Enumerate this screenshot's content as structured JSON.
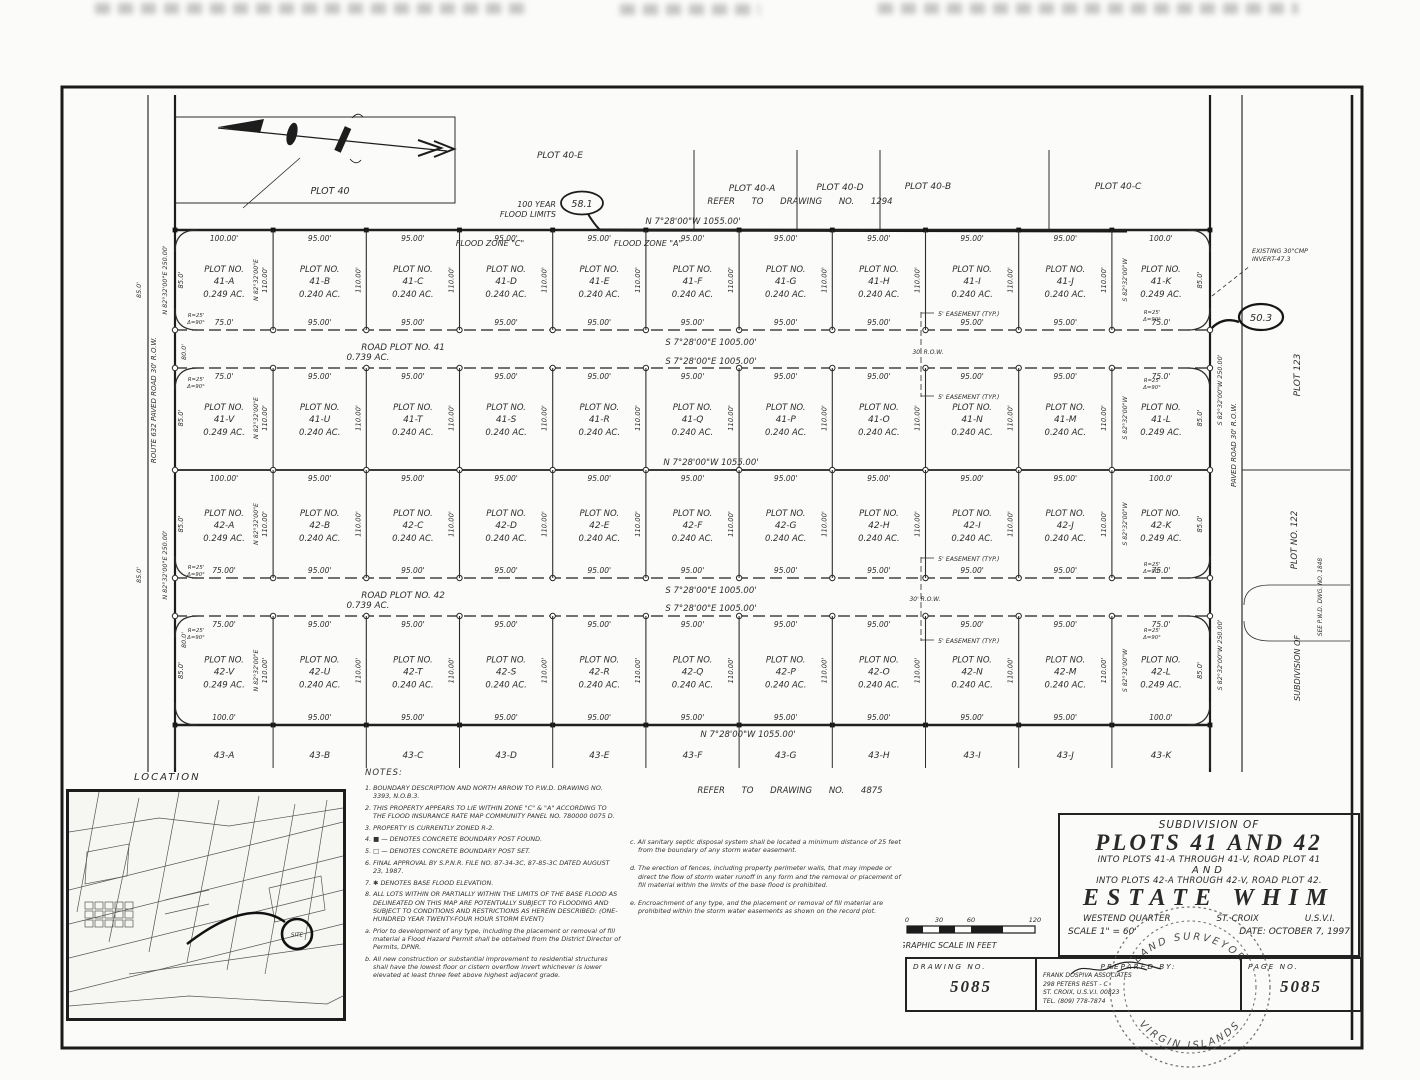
{
  "map": {
    "plot40": {
      "label": "PLOT 40",
      "e": "PLOT 40-E",
      "a": "PLOT 40-A",
      "d": "PLOT 40-D",
      "b": "PLOT 40-B",
      "c": "PLOT 40-C"
    },
    "refer_top": "REFER  TO  DRAWING  NO.  1294",
    "refer_bottom": "REFER  TO  DRAWING  NO.  4875",
    "bearing_top": "N 7°28'00\"W   1055.00'",
    "bearing_mid": "N 7°28'00\"W   1055.00'",
    "bearing_bottom": "N 7°28'00\"W   1055.00'",
    "flood_limits_1": "100 YEAR",
    "flood_limits_2": "FLOOD LIMITS",
    "flood_elev_a": "58.1",
    "flood_elev_b": "50.3",
    "flood_zone_c": "FLOOD ZONE \"C\"",
    "flood_zone_a": "FLOOD ZONE \"A\"",
    "existing_cmp_1": "EXISTING 30\"CMP",
    "existing_cmp_2": "INVERT-47.3",
    "easement": "5' EASEMENT (TYP.)",
    "corner_r": "R=25'",
    "corner_d": "Δ=90°",
    "left_road": "ROUTE  632      PAVED  ROAD   30'  R.O.W.",
    "left_bearing": "N 82°32'00\"E   250.00'",
    "gap_dim": "80.0'",
    "outer_dim": "85.0'",
    "right_road": "PAVED   ROAD   30'   R.O.W.",
    "right_bearing": "S 82°32'00\"W   250.00'",
    "plot123": "PLOT 123",
    "plot122": "PLOT NO. 122",
    "subdivision_of": "SUBDIVISION OF",
    "see_dwg": "SEE  P.W.D.  DWG.  NO.  1848",
    "roads": {
      "r41_name": "ROAD PLOT NO. 41",
      "r41_area": "0.739 AC.",
      "r42_name": "ROAD PLOT NO. 42",
      "r42_area": "0.739 AC.",
      "bearing": "S 7°28'00\"E    1005.00'",
      "row_label": "30' R.O.W."
    }
  },
  "grid": {
    "col_widths_ft": [
      100,
      95,
      95,
      95,
      95,
      95,
      95,
      95,
      95,
      95,
      100
    ],
    "plot_label": "PLOT NO.",
    "interior_dim": "110.00'",
    "edge_dim": "85.0'",
    "bearing_left": "N 82°32'00\"E",
    "bearing_right": "S 82°32'00\"W",
    "rows": [
      {
        "top_dims": [
          "100.00'",
          "95.00'",
          "95.00'",
          "95.00'",
          "95.00'",
          "95.00'",
          "95.00'",
          "95.00'",
          "95.00'",
          "95.00'",
          "100.0'"
        ],
        "bottom_dims": [
          "75.0'",
          "95.00'",
          "95.00'",
          "95.00'",
          "95.00'",
          "95.00'",
          "95.00'",
          "95.00'",
          "95.00'",
          "95.00'",
          "75.0'"
        ],
        "plots": [
          {
            "no": "41-A",
            "area": "0.249 AC."
          },
          {
            "no": "41-B",
            "area": "0.240 AC."
          },
          {
            "no": "41-C",
            "area": "0.240 AC."
          },
          {
            "no": "41-D",
            "area": "0.240 AC."
          },
          {
            "no": "41-E",
            "area": "0.240 AC."
          },
          {
            "no": "41-F",
            "area": "0.240 AC."
          },
          {
            "no": "41-G",
            "area": "0.240 AC."
          },
          {
            "no": "41-H",
            "area": "0.240 AC."
          },
          {
            "no": "41-I",
            "area": "0.240 AC."
          },
          {
            "no": "41-J",
            "area": "0.240 AC."
          },
          {
            "no": "41-K",
            "area": "0.249 AC."
          }
        ]
      },
      {
        "top_dims": [
          "75.0'",
          "95.00'",
          "95.00'",
          "95.00'",
          "95.00'",
          "95.00'",
          "95.00'",
          "95.00'",
          "95.00'",
          "95.00'",
          "75.0'"
        ],
        "bottom_dims": null,
        "plots": [
          {
            "no": "41-V",
            "area": "0.249 AC."
          },
          {
            "no": "41-U",
            "area": "0.240 AC."
          },
          {
            "no": "41-T",
            "area": "0.240 AC."
          },
          {
            "no": "41-S",
            "area": "0.240 AC."
          },
          {
            "no": "41-R",
            "area": "0.240 AC."
          },
          {
            "no": "41-Q",
            "area": "0.240 AC."
          },
          {
            "no": "41-P",
            "area": "0.240 AC."
          },
          {
            "no": "41-O",
            "area": "0.240 AC."
          },
          {
            "no": "41-N",
            "area": "0.240 AC."
          },
          {
            "no": "41-M",
            "area": "0.240 AC."
          },
          {
            "no": "41-L",
            "area": "0.249 AC."
          }
        ]
      },
      {
        "top_dims": [
          "100.00'",
          "95.00'",
          "95.00'",
          "95.00'",
          "95.00'",
          "95.00'",
          "95.00'",
          "95.00'",
          "95.00'",
          "95.00'",
          "100.0'"
        ],
        "bottom_dims": [
          "75.00'",
          "95.00'",
          "95.00'",
          "95.00'",
          "95.00'",
          "95.00'",
          "95.00'",
          "95.00'",
          "95.00'",
          "95.00'",
          "75.0'"
        ],
        "plots": [
          {
            "no": "42-A",
            "area": "0.249 AC."
          },
          {
            "no": "42-B",
            "area": "0.240 AC."
          },
          {
            "no": "42-C",
            "area": "0.240 AC."
          },
          {
            "no": "42-D",
            "area": "0.240 AC."
          },
          {
            "no": "42-E",
            "area": "0.240 AC."
          },
          {
            "no": "42-F",
            "area": "0.240 AC."
          },
          {
            "no": "42-G",
            "area": "0.240 AC."
          },
          {
            "no": "42-H",
            "area": "0.240 AC."
          },
          {
            "no": "42-I",
            "area": "0.240 AC."
          },
          {
            "no": "42-J",
            "area": "0.240 AC."
          },
          {
            "no": "42-K",
            "area": "0.249 AC."
          }
        ]
      },
      {
        "top_dims": [
          "75.00'",
          "95.00'",
          "95.00'",
          "95.00'",
          "95.00'",
          "95.00'",
          "95.00'",
          "95.00'",
          "95.00'",
          "95.00'",
          "75.0'"
        ],
        "bottom_dims": [
          "100.0'",
          "95.00'",
          "95.00'",
          "95.00'",
          "95.00'",
          "95.00'",
          "95.00'",
          "95.00'",
          "95.00'",
          "95.00'",
          "100.0'"
        ],
        "plots": [
          {
            "no": "42-V",
            "area": "0.249 AC."
          },
          {
            "no": "42-U",
            "area": "0.240 AC."
          },
          {
            "no": "42-T",
            "area": "0.240 AC."
          },
          {
            "no": "42-S",
            "area": "0.240 AC."
          },
          {
            "no": "42-R",
            "area": "0.240 AC."
          },
          {
            "no": "42-Q",
            "area": "0.240 AC."
          },
          {
            "no": "42-P",
            "area": "0.240 AC."
          },
          {
            "no": "42-O",
            "area": "0.240 AC."
          },
          {
            "no": "42-N",
            "area": "0.240 AC."
          },
          {
            "no": "42-M",
            "area": "0.240 AC."
          },
          {
            "no": "42-L",
            "area": "0.249 AC."
          }
        ]
      }
    ],
    "bottom_labels": [
      "43-A",
      "43-B",
      "43-C",
      "43-D",
      "43-E",
      "43-F",
      "43-G",
      "43-H",
      "43-I",
      "43-J",
      "43-K"
    ]
  },
  "location": {
    "label": "LOCATION",
    "site": "SITE"
  },
  "notes": {
    "header": "NOTES:",
    "left": [
      "1. BOUNDARY DESCRIPTION AND NORTH ARROW TO P.W.D. DRAWING NO. 3393, N.O.B.3.",
      "2. THIS PROPERTY APPEARS TO LIE WITHIN ZONE \"C\" & \"A\" ACCORDING TO THE FLOOD INSURANCE RATE MAP COMMUNITY PANEL NO. 780000 0075 D.",
      "3. PROPERTY IS CURRENTLY ZONED R-2.",
      "4. ■ — DENOTES CONCRETE BOUNDARY POST FOUND.",
      "5. □ — DENOTES CONCRETE BOUNDARY POST SET.",
      "6. FINAL APPROVAL BY S.P.N.R. FILE NO. 87-34-3C, 87-85-3C DATED AUGUST 23, 1987.",
      "7. ✱ DENOTES BASE FLOOD ELEVATION.",
      "8. ALL LOTS WITHIN OR PARTIALLY WITHIN THE LIMITS OF THE BASE FLOOD AS DELINEATED ON THIS MAP ARE POTENTIALLY SUBJECT TO FLOODING AND SUBJECT TO CONDITIONS AND RESTRICTIONS AS HEREIN DESCRIBED: (ONE-HUNDRED YEAR TWENTY-FOUR HOUR STORM EVENT)",
      "a. Prior to development of any type, including the placement or removal of fill material a Flood Hazard Permit shall be obtained from the District Director of Permits, DPNR.",
      "b. All new construction or substantial improvement to residential structures shall have the lowest floor or cistern overflow invert whichever is lower elevated at least three feet above highest adjacent grade."
    ],
    "right": [
      "c. All sanitary septic disposal system shall be located a minimum distance of 25 feet from the boundary of any storm water easement.",
      "d. The erection of fences, including property perimeter walls, that may impede or direct the flow of storm water runoff in any form and the removal or placement of fill material within the limits of the base flood is prohibited.",
      "e. Encroachment of any type, and the placement or removal of fill material are prohibited within the storm water easements as shown on the record plot."
    ]
  },
  "scalebar": {
    "ticks": [
      "0",
      "30",
      "60",
      "120"
    ],
    "caption": "GRAPHIC SCALE IN FEET"
  },
  "title_block": {
    "l1": "SUBDIVISION OF",
    "l2": "PLOTS 41 AND 42",
    "l3": "INTO PLOTS 41-A THROUGH 41-V, ROAD PLOT 41",
    "l4": "AND",
    "l5": "INTO PLOTS 42-A THROUGH 42-V, ROAD PLOT 42.",
    "l6": "ESTATE WHIM",
    "l7a": "WESTEND QUARTER",
    "l7b": "ST. CROIX",
    "l7c": "U.S.V.I.",
    "l8a": "SCALE 1\" = 60'",
    "l8b": "DATE: OCTOBER 7, 1997"
  },
  "strip": {
    "drawing_label": "DRAWING NO.",
    "drawing_value": "5085",
    "prepared_label": "PREPARED BY:",
    "firm": "FRANK DOSPIVA ASSOCIATES",
    "addr1": "298 PETERS REST - C",
    "addr2": "ST. CROIX, U.S.V.I. 00823",
    "tel": "TEL. (809) 778-7874",
    "page_label": "PAGE NO.",
    "page_value": "5085"
  },
  "seal": {
    "top": "LAND SURVEYOR",
    "bottom": "VIRGIN ISLANDS"
  }
}
